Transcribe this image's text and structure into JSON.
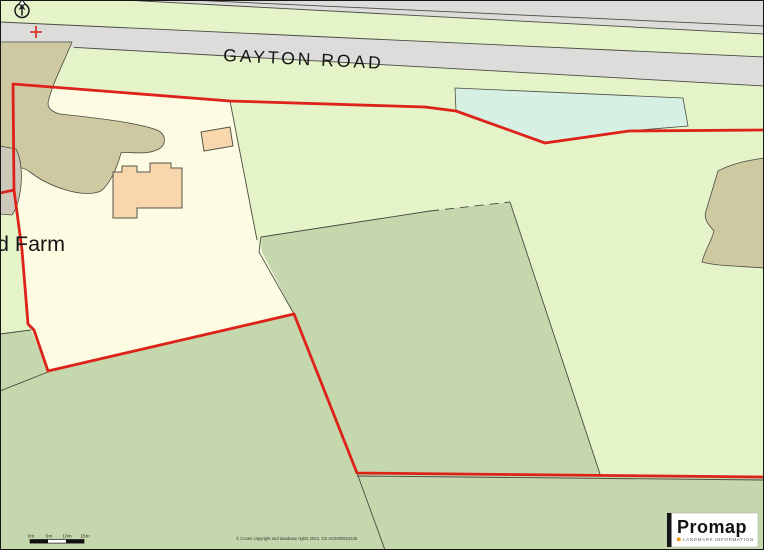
{
  "map": {
    "road_label": "GAYTON ROAD",
    "place_label": "d Farm",
    "scale_labels": [
      "0m",
      "5m",
      "10m",
      "15m"
    ],
    "copyright": "© Crown copyright and database rights 2024. OS AC0000813445"
  },
  "logo": {
    "brand": "Promap",
    "subtitle": "LANDMARK INFORMATION"
  },
  "colors": {
    "field-light": "#e5f3c8",
    "field-sage": "#c5d7ac",
    "plot-cream": "#fdfce2",
    "track-khaki": "#cfc9a2",
    "yard-gray": "#cdc9ba",
    "road-gray": "#dcdcdb",
    "pond-mint": "#d6f1e3",
    "building-peach": "#f7d7ab",
    "boundary-red": "#dd221a",
    "line-dark": "#4a4b42",
    "logo-orange": "#f09609"
  }
}
